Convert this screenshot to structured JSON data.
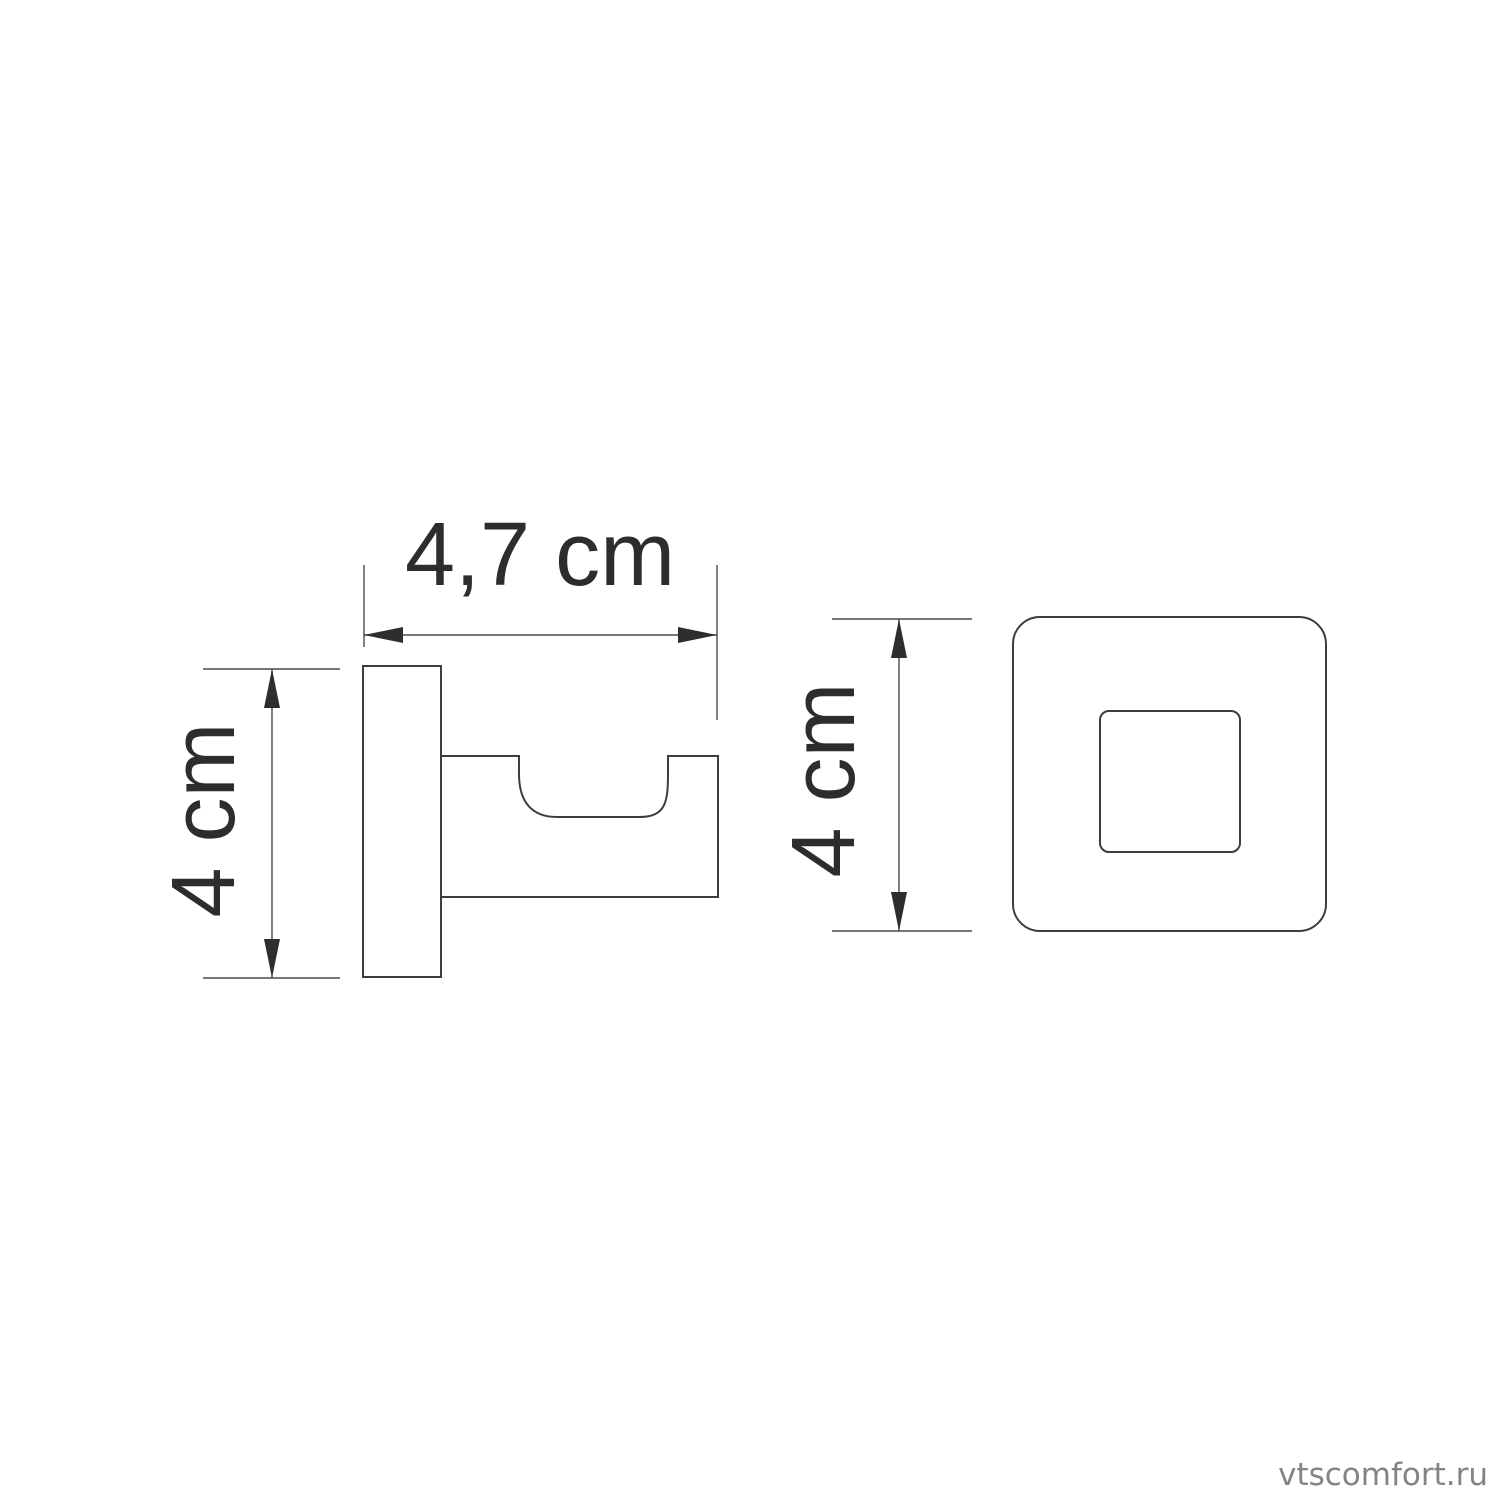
{
  "drawing": {
    "side_view": {
      "width_dimension_label": "4,7 cm",
      "height_dimension_label": "4 cm"
    },
    "front_view": {
      "height_dimension_label": "4 cm"
    },
    "watermark_text": "vtscomfort.ru",
    "colors": {
      "outline": "#3d3d3d",
      "dimension_line": "#4b4b4b",
      "arrowhead": "#2e2e2e",
      "dimension_text": "#2d2d2d",
      "watermark_text_color": "#848484",
      "background": "#ffffff"
    }
  }
}
